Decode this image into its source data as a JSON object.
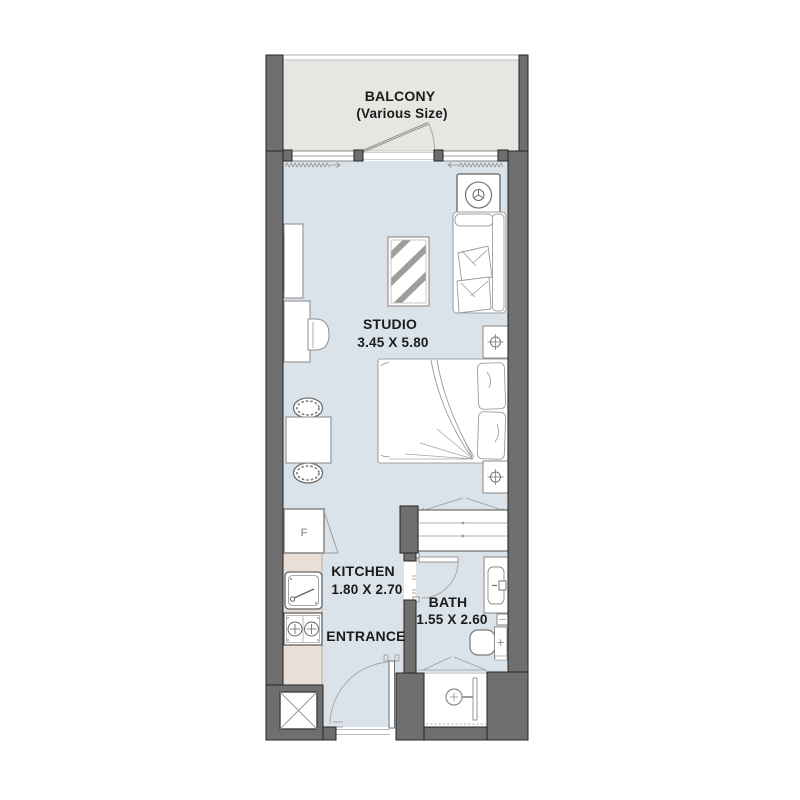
{
  "meta": {
    "title": "Studio Apartment Floor Plan"
  },
  "rooms": {
    "balcony": {
      "name": "BALCONY",
      "note": "(Various Size)"
    },
    "studio": {
      "name": "STUDIO",
      "dims": "3.45 X 5.80"
    },
    "kitchen": {
      "name": "KITCHEN",
      "dims": "1.80 X 2.70"
    },
    "bath": {
      "name": "BATH",
      "dims": "1.55 X 2.60"
    },
    "entrance": {
      "name": "ENTRANCE"
    }
  },
  "appliances": {
    "fridge_label": "F"
  },
  "colors": {
    "wall": "#6f6f6f",
    "floor": "#dbe3ea",
    "balcony_floor": "#e7e6e3",
    "kitchen_counter": "#eadfd7",
    "furniture_stroke": "#8f8f8f",
    "text": "#1b1b1b"
  },
  "icons": [
    "washing-machine-icon",
    "sofa-icon",
    "tv-unit-icon",
    "desk-icon",
    "desk-chair-icon",
    "rug-icon",
    "dining-table-icon",
    "dining-chair-icon",
    "double-bed-icon",
    "nightstand-icon",
    "wardrobe-icon",
    "fridge-icon",
    "kitchen-sink-icon",
    "stove-icon",
    "vanity-sink-icon",
    "toilet-icon",
    "shower-icon",
    "service-shaft-icon",
    "door-swing-icon",
    "window-icon",
    "curtain-icon"
  ]
}
